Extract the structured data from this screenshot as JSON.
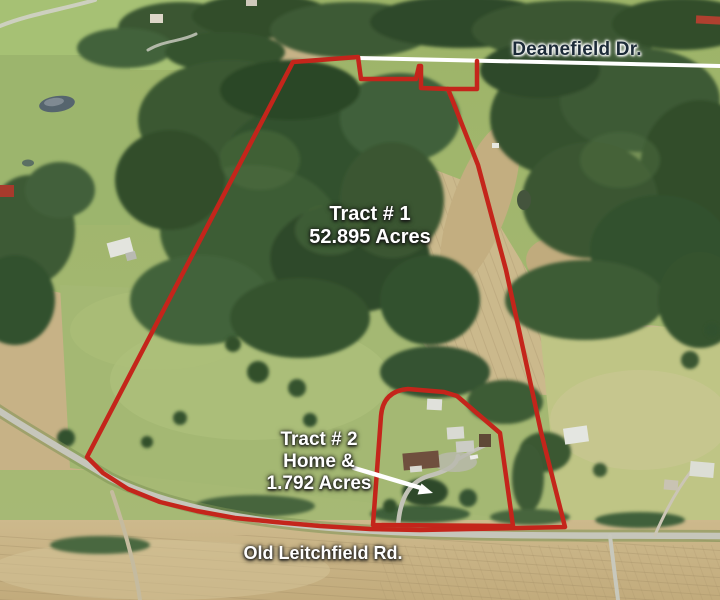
{
  "image": {
    "description": "Aerial drone photo of rural land listing with two outlined tracts"
  },
  "labels": {
    "road_top": "Deanefield Dr.",
    "road_bottom": "Old Leitchfield Rd.",
    "tract1": {
      "name": "Tract # 1",
      "acreage": "52.895 Acres"
    },
    "tract2": {
      "name": "Tract # 2",
      "home": "Home &",
      "acreage": "1.792 Acres"
    }
  },
  "colors": {
    "boundary_red": "#c4251b",
    "road_line_white": "#ffffff",
    "label_dark": "#1c2b38",
    "label_white": "#ffffff"
  }
}
